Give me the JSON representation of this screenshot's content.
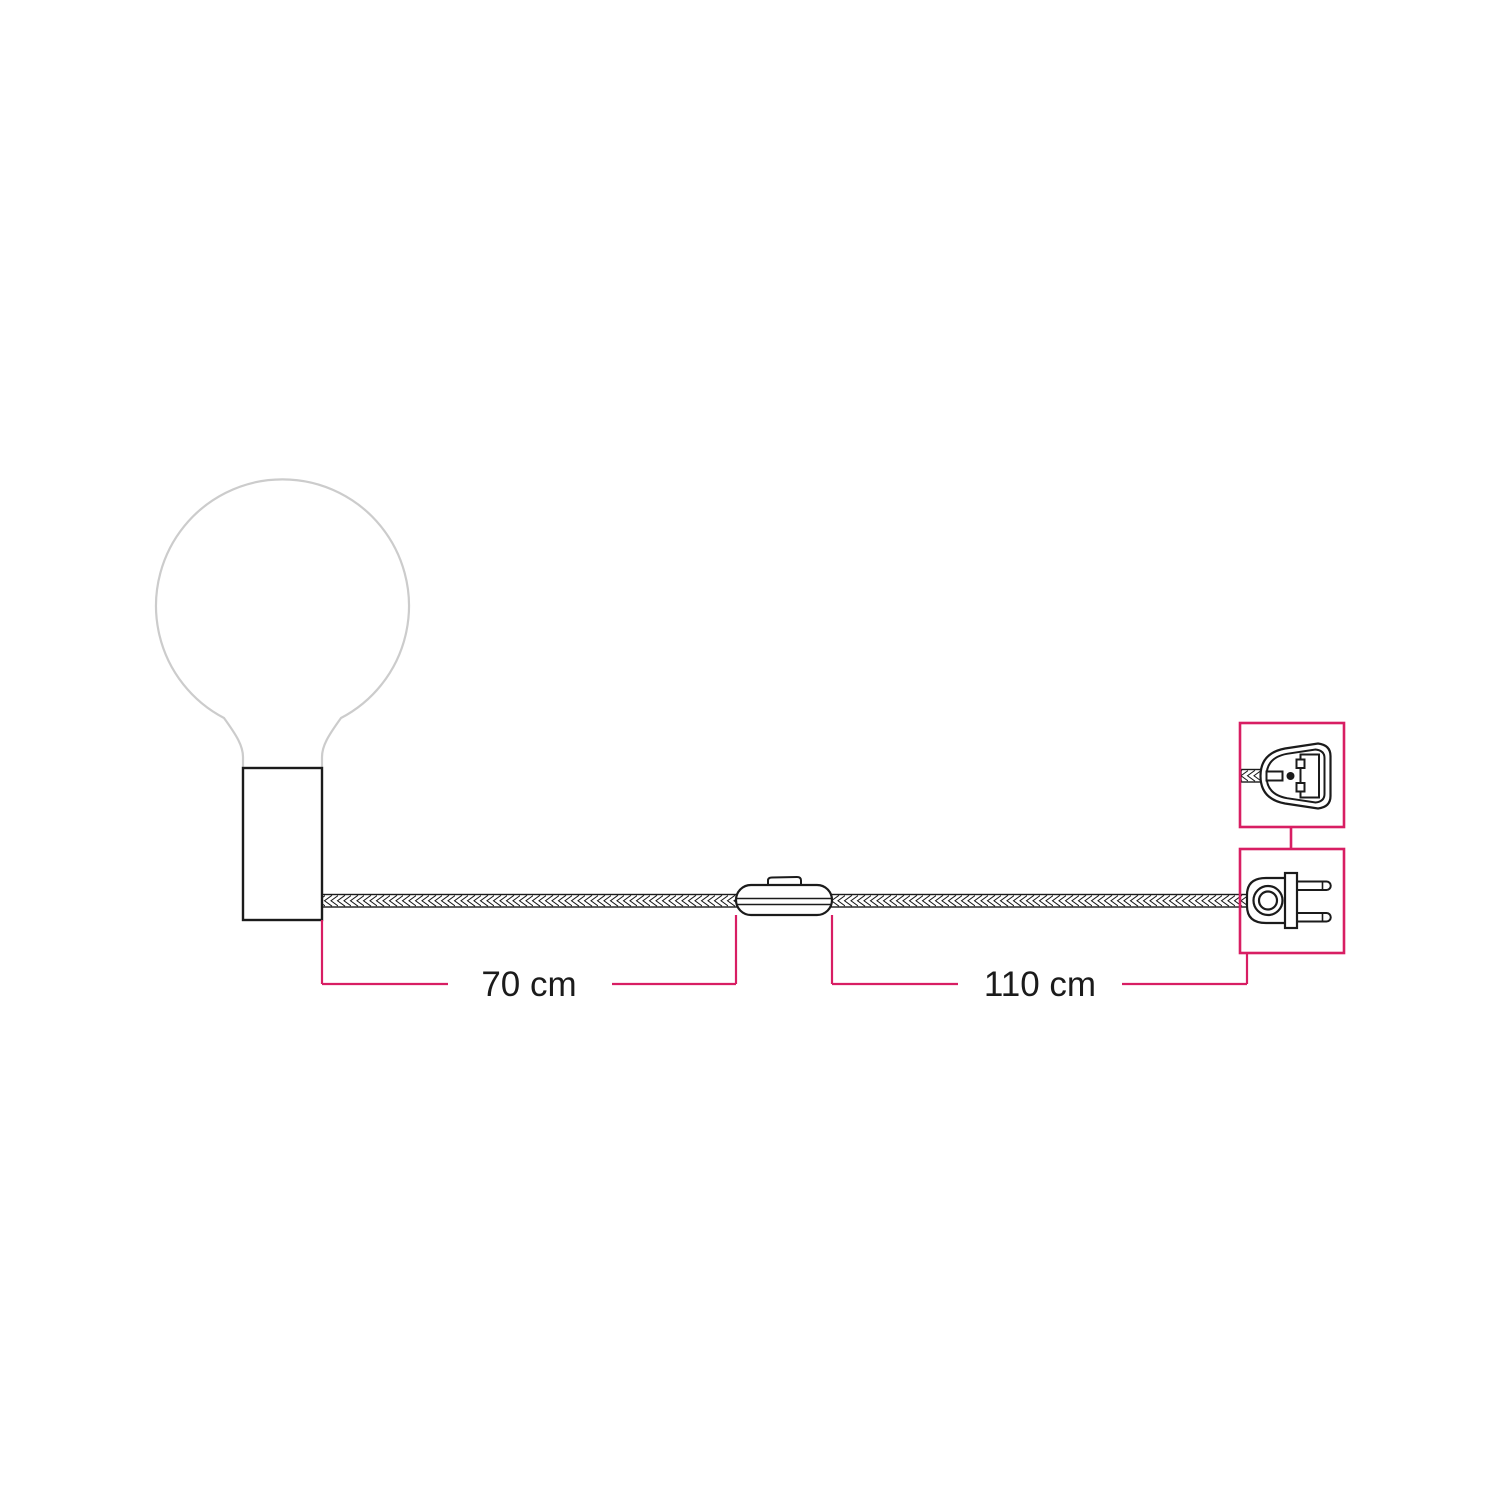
{
  "colors": {
    "accent": "#d81e63",
    "ink": "#1b1b1b",
    "bulb_outline": "#cccccc",
    "background": "#ffffff"
  },
  "dimensions": {
    "seg1": {
      "label": "70 cm"
    },
    "seg2": {
      "label": "110 cm"
    }
  },
  "components": {
    "bulb": "globe-light-bulb-icon",
    "lamp_holder": "cylindrical-lamp-holder-icon",
    "cable": "braided-cable-icon",
    "switch": "inline-switch-icon",
    "plug": "two-pin-euro-plug-icon",
    "plug_detail": "uk-plug-adapter-icon"
  }
}
